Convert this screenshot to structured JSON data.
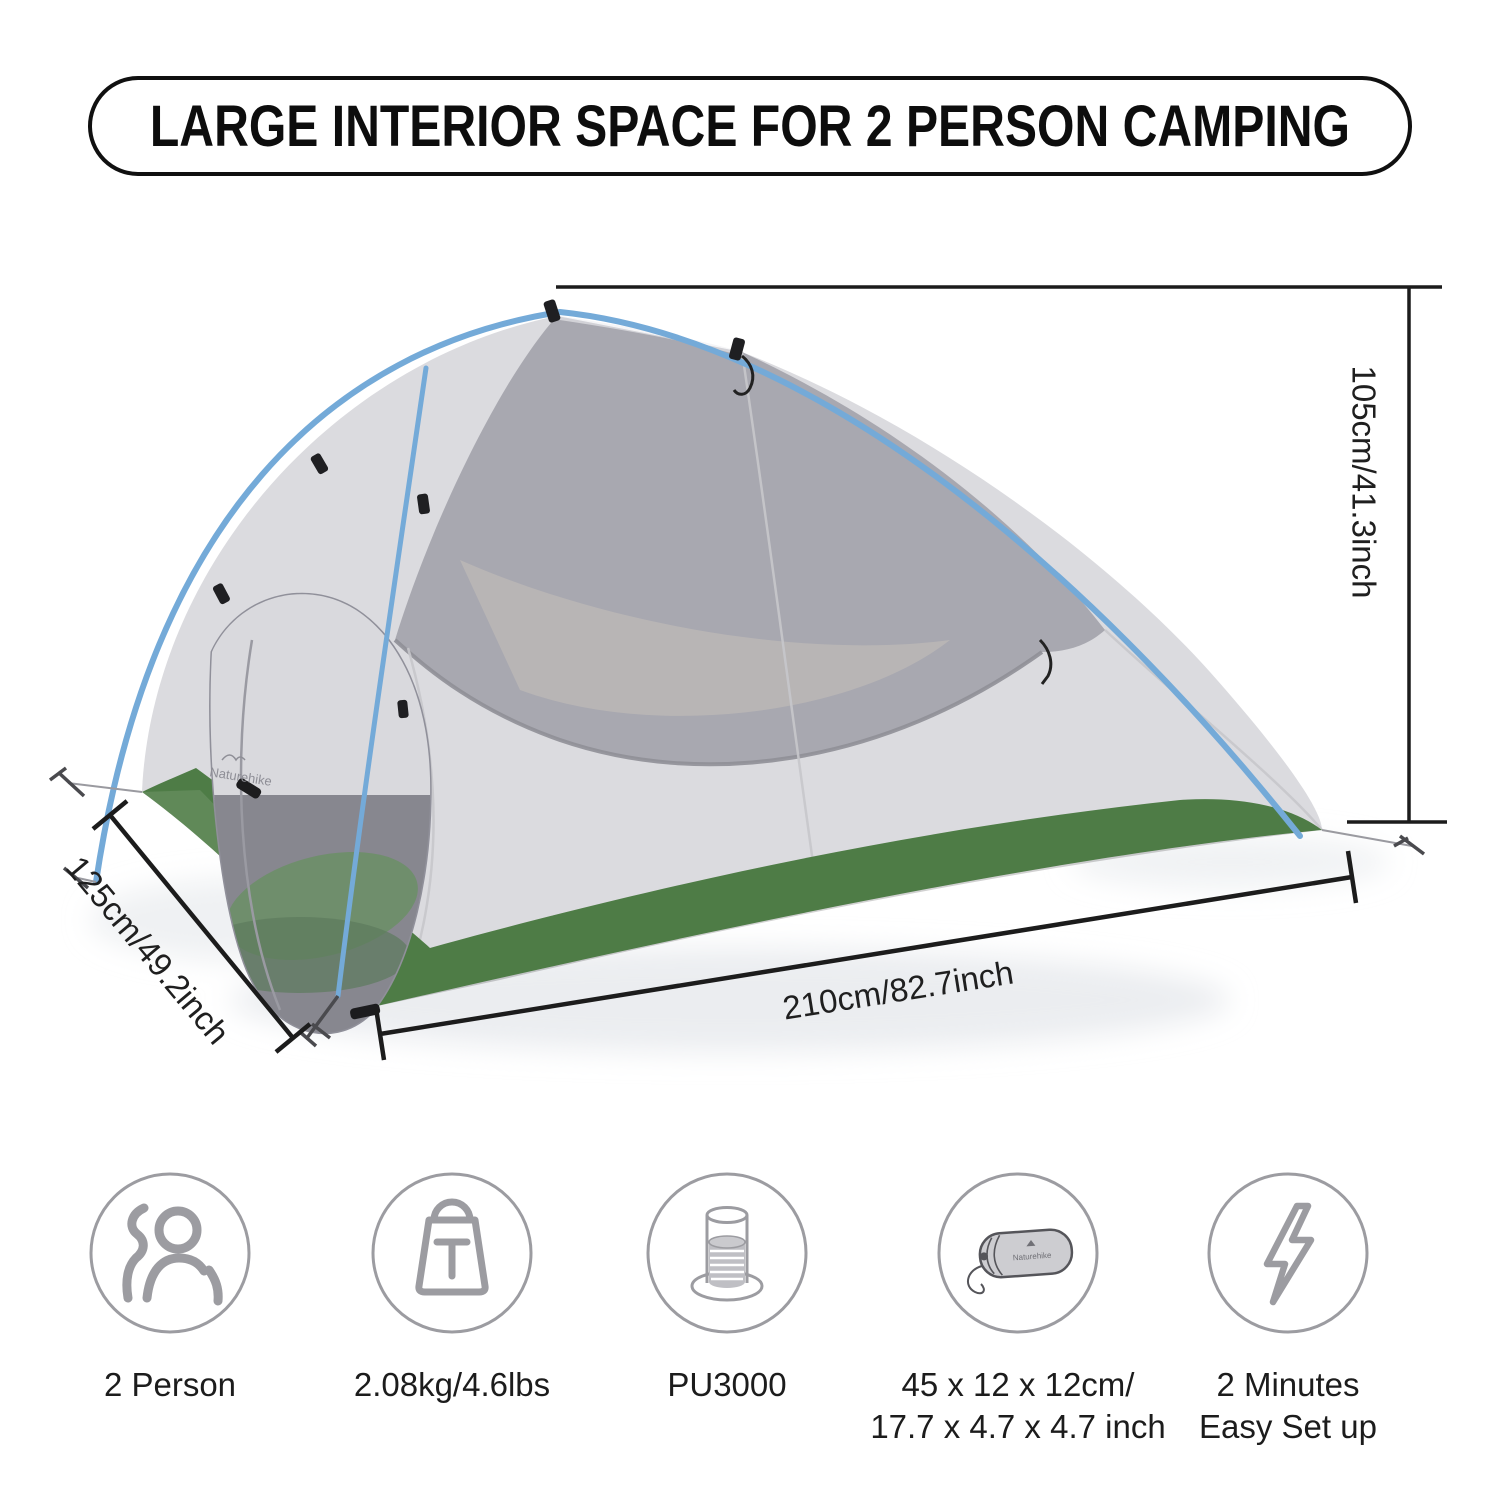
{
  "title": "LARGE INTERIOR SPACE FOR 2 PERSON CAMPING",
  "dimensions": {
    "height_label": "105cm/41.3inch",
    "depth_label": "125cm/49.2inch",
    "length_label": "210cm/82.7inch"
  },
  "tent": {
    "brand": "Naturehike",
    "colors": {
      "fabric": "#dbdbdf",
      "mesh": "#a5a5ad",
      "floor_green": "#4e7c46",
      "pole_blue": "#74aad8",
      "line_black": "#1c1c1c"
    }
  },
  "features": [
    {
      "icon": "two-person-icon",
      "label": "2 Person"
    },
    {
      "icon": "weight-icon",
      "label": "2.08kg/4.6lbs"
    },
    {
      "icon": "waterproof-rating-icon",
      "label": "PU3000"
    },
    {
      "icon": "packed-size-icon",
      "label": "45 x 12 x 12cm/\n17.7 x 4.7 x 4.7 inch"
    },
    {
      "icon": "quick-setup-icon",
      "label": "2 Minutes\nEasy Set up"
    }
  ]
}
